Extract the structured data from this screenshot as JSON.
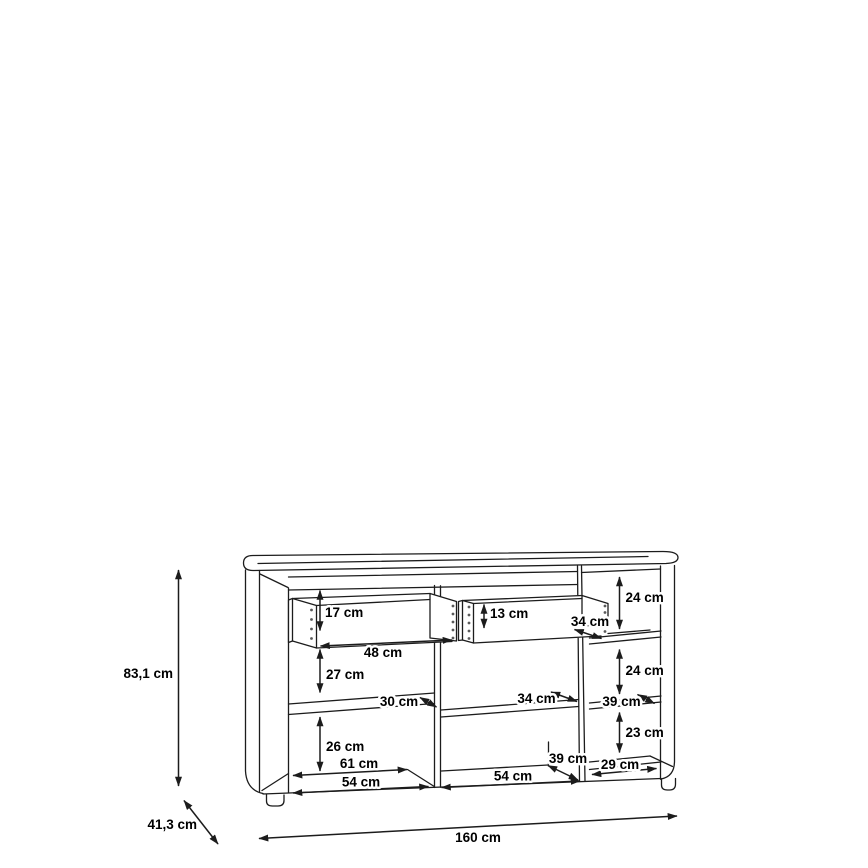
{
  "diagram": {
    "labels": {
      "height": "83,1 cm",
      "depth": "41,3 cm",
      "width": "160 cm",
      "drawer_left_height": "17 cm",
      "drawer_left_depth": "48 cm",
      "left_upper_gap": "27 cm",
      "left_shelf_depth": "30 cm",
      "left_lower_gap": "26 cm",
      "left_width_back": "61 cm",
      "left_width_front": "54 cm",
      "drawer_mid_height": "13 cm",
      "drawer_mid_depth": "34 cm",
      "mid_shelf_depth": "34 cm",
      "mid_floor_depth": "39 cm",
      "mid_width": "54 cm",
      "right_upper_gap": "24 cm",
      "right_mid_gap": "24 cm",
      "right_shelf_depth": "39 cm",
      "right_lower_gap": "23 cm",
      "right_width": "29 cm"
    },
    "colors": {
      "line": "#1c1c1c",
      "background": "#ffffff",
      "text": "#000000"
    }
  }
}
